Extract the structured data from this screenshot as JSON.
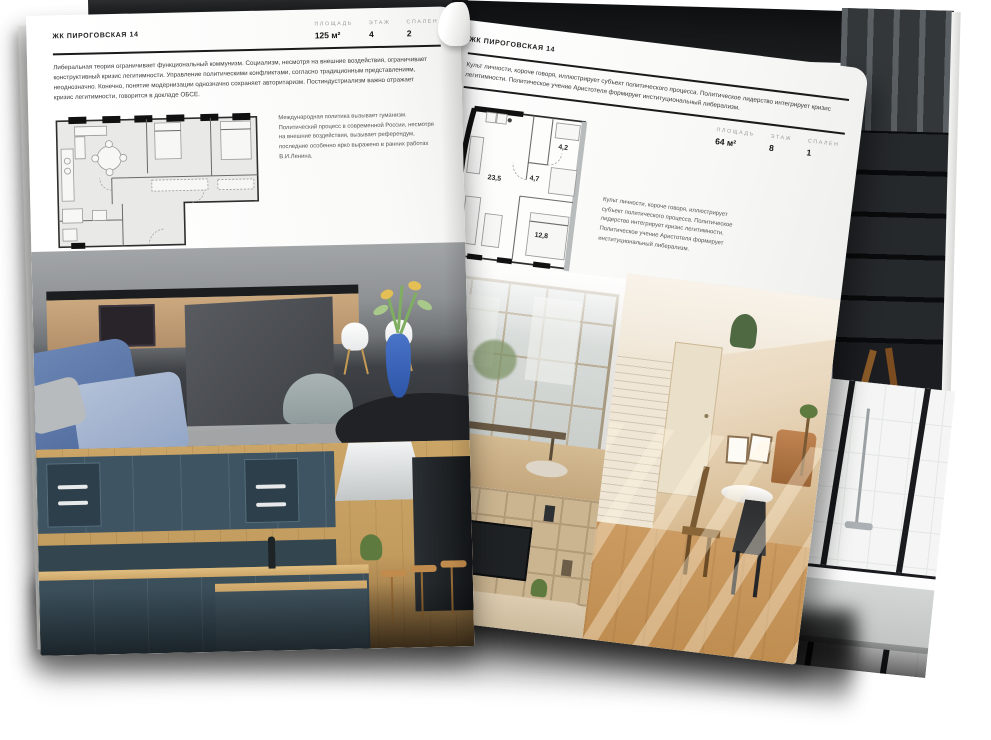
{
  "left_page": {
    "title": "ЖК ПИРОГОВСКАЯ 14",
    "stats": [
      {
        "label": "ПЛОЩАДЬ",
        "value": "125 м²"
      },
      {
        "label": "ЭТАЖ",
        "value": "4"
      },
      {
        "label": "СПАЛЕН",
        "value": "2"
      }
    ],
    "paragraph": "Либеральная теория ограничивает функциональный коммунизм. Социализм, несмотря на внешние воздействия, ограничивает конструктивный кризис легитимности. Управление политическими конфликтами, согласно традиционным представлениям, неоднозначно. Конечно, понятие модернизации однозначно сохраняет авторитаризм. Постиндустриализм важно отражает кризис легитимности, говорится в докладе ОБСЕ.",
    "note": "Международная политика вызывает гуманизм. Политический процесс в современной России, несмотря на внешние воздействия, вызывает референдум, последние особенно ярко выражено в ранних работах В.И.Ленина."
  },
  "right_page": {
    "title": "ЖК ПИРОГОВСКАЯ 14",
    "stats": [
      {
        "label": "ПЛОЩАДЬ",
        "value": "64 м²"
      },
      {
        "label": "ЭТАЖ",
        "value": "8"
      },
      {
        "label": "СПАЛЕН",
        "value": "1"
      }
    ],
    "paragraph": "Культ личности, короче говоря, иллюстрирует субъект политического процесса. Политическое лидерство интегрирует кризис легитимности. Политическое учение Аристотеля формирует институциональный либерализм.",
    "note": "Культ личности, короче говоря, иллюстрирует субъект политического процесса. Политическое лидерство интегрирует кризис легитимности. Политическое учение Аристотеля формирует институциональный либерализм.",
    "floorplan": {
      "rooms": [
        {
          "area": "23,5"
        },
        {
          "area": "4,7"
        },
        {
          "area": "4,2"
        },
        {
          "area": "12,8"
        }
      ]
    }
  },
  "colors": {
    "page": "#fbfbfa",
    "rule": "#1a1a1a",
    "stat_label": "#9a9a9a",
    "text": "#3a3a3a",
    "accent_blue": "#3a66c0",
    "cabinet_teal": "#3f5462",
    "wood": "#c99f63"
  }
}
